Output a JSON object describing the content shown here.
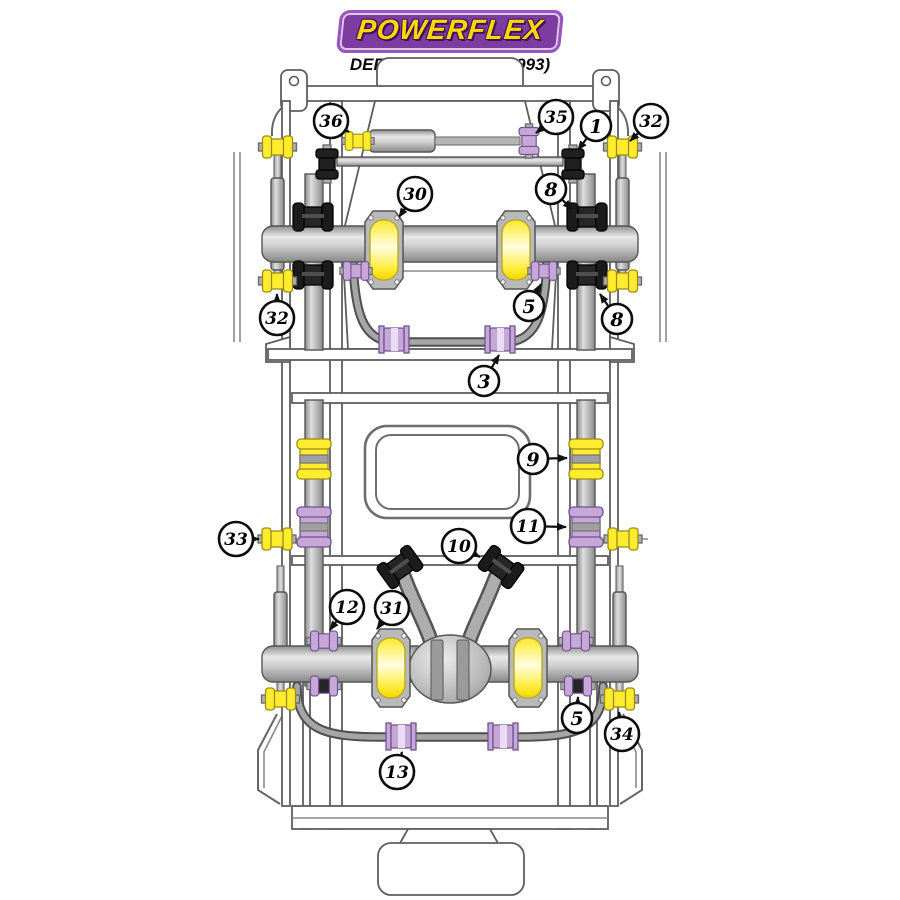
{
  "header": {
    "brand": "POWERFLEX",
    "model_line": "DEFENDER (1984 - 1993)"
  },
  "colors": {
    "logo_bg": "#7d3da0",
    "logo_text": "#ffd800",
    "bush_yellow": "#ffec2e",
    "bush_yellow_stroke": "#9a8c17",
    "bush_purple": "#c6a7d8",
    "bush_purple_stroke": "#6f5390",
    "bush_black": "#1e1e1e",
    "line_gray": "#5e5e5e"
  },
  "diagram": {
    "description": "Chassis plan view with suspension bush locations",
    "callouts": [
      {
        "id": "36",
        "label": "36",
        "cx": 331,
        "cy": 121,
        "tx": 349,
        "ty": 132,
        "target": "steering-damper-yellow-bush"
      },
      {
        "id": "35",
        "label": "35",
        "cx": 556,
        "cy": 117,
        "tx": 536,
        "ty": 133,
        "target": "steering-damper-purple-bush"
      },
      {
        "id": "1",
        "label": "1",
        "cx": 596,
        "cy": 126,
        "tx": 578,
        "ty": 150,
        "target": "track-rod-end-bush"
      },
      {
        "id": "32-top",
        "label": "32",
        "cx": 651,
        "cy": 121,
        "tx": 630,
        "ty": 141,
        "target": "front-shock-upper-bush-right"
      },
      {
        "id": "30",
        "label": "30",
        "cx": 415,
        "cy": 194,
        "tx": 399,
        "ty": 217,
        "target": "front-spring-seat-left"
      },
      {
        "id": "8-top",
        "label": "8",
        "cx": 551,
        "cy": 189,
        "tx": 572,
        "ty": 209,
        "target": "radius-arm-upper-bush-right"
      },
      {
        "id": "32-left",
        "label": "32",
        "cx": 277,
        "cy": 318,
        "tx": 277,
        "ty": 294,
        "target": "front-shock-lower-bush-left"
      },
      {
        "id": "5-front",
        "label": "5",
        "cx": 529,
        "cy": 306,
        "tx": 541,
        "ty": 284,
        "target": "panhard-rod-bush-right"
      },
      {
        "id": "8-right",
        "label": "8",
        "cx": 617,
        "cy": 319,
        "tx": 600,
        "ty": 294,
        "target": "radius-arm-lower-bush-right"
      },
      {
        "id": "3",
        "label": "3",
        "cx": 484,
        "cy": 381,
        "tx": 499,
        "ty": 355,
        "target": "front-anti-roll-bar-bush-right"
      },
      {
        "id": "9",
        "label": "9",
        "cx": 533,
        "cy": 459,
        "tx": 567,
        "ty": 458,
        "target": "trailing-arm-yellow-bush-right"
      },
      {
        "id": "11",
        "label": "11",
        "cx": 528,
        "cy": 526,
        "tx": 566,
        "ty": 527,
        "target": "trailing-arm-purple-bush-right"
      },
      {
        "id": "33",
        "label": "33",
        "cx": 236,
        "cy": 539,
        "tx": 259,
        "ty": 539,
        "target": "chassis-side-bush-left"
      },
      {
        "id": "10",
        "label": "10",
        "cx": 459,
        "cy": 546,
        "tx": 480,
        "ty": 557,
        "target": "a-frame-bush-right"
      },
      {
        "id": "12",
        "label": "12",
        "cx": 347,
        "cy": 607,
        "tx": 330,
        "ty": 630,
        "target": "rear-axle-spool-bush-left"
      },
      {
        "id": "31",
        "label": "31",
        "cx": 392,
        "cy": 608,
        "tx": 377,
        "ty": 629,
        "target": "rear-spring-seat-left"
      },
      {
        "id": "5-rear",
        "label": "5",
        "cx": 577,
        "cy": 718,
        "tx": 578,
        "ty": 697,
        "target": "rear-axle-lower-bush-right"
      },
      {
        "id": "34",
        "label": "34",
        "cx": 622,
        "cy": 734,
        "tx": 619,
        "ty": 712,
        "target": "rear-shock-lower-bush-right"
      },
      {
        "id": "13",
        "label": "13",
        "cx": 397,
        "cy": 772,
        "tx": 402,
        "ty": 752,
        "target": "rear-anti-roll-bar-bush-left"
      }
    ]
  }
}
